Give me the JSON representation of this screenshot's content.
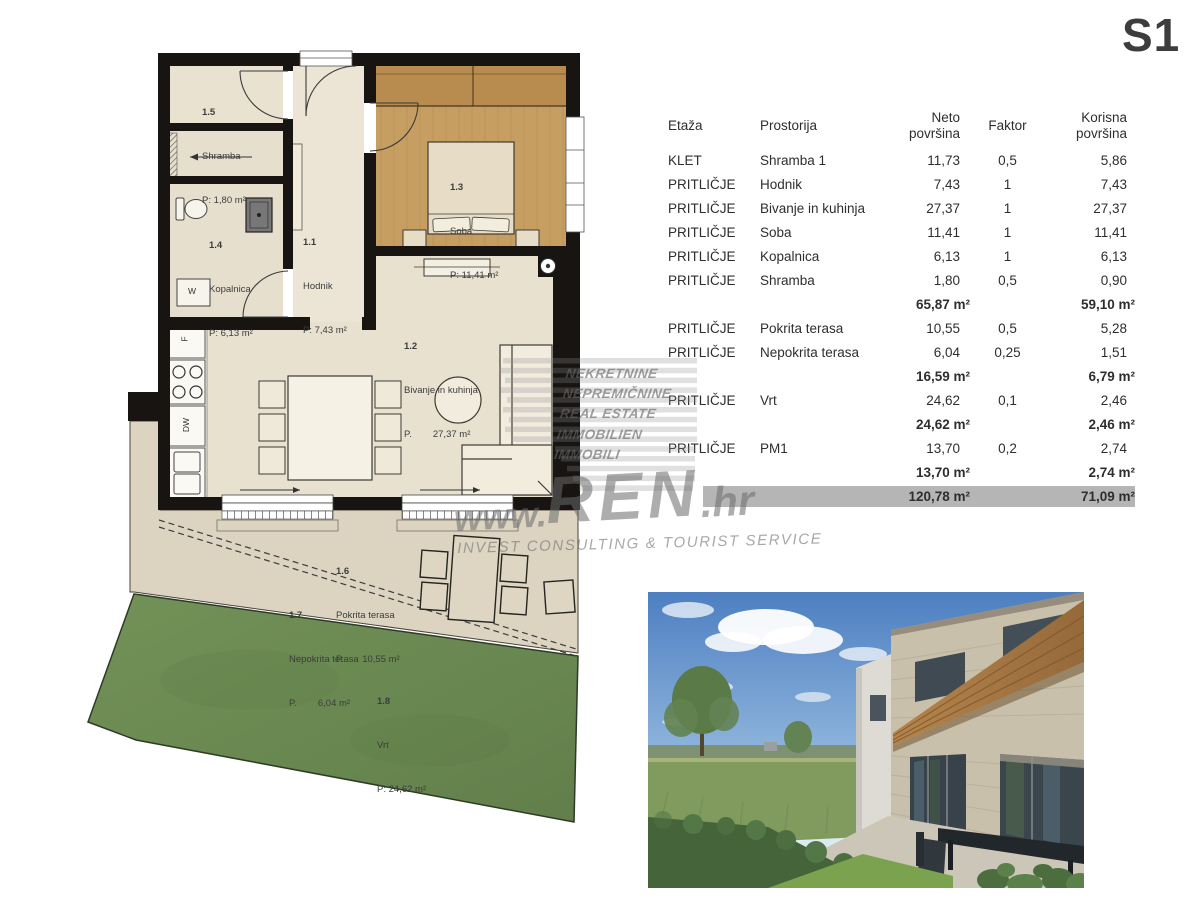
{
  "unit_label": "S1",
  "colors": {
    "wall": "#171412",
    "floor_beige": "#e9e1d0",
    "floor_wood": "#c79e62",
    "terrace": "#dcd4c1",
    "garden": "#6d8f54",
    "total_row_bg": "#b5b5b5",
    "watermark_gray": "#8a8a8a"
  },
  "watermark": {
    "brand_lines": [
      "NEKRETNINE",
      "NEPREMIČNINE",
      "REAL ESTATE",
      "IMMOBILIEN",
      "IMMOBILI"
    ],
    "url_www": "www.",
    "url_name": "REN",
    "url_tld": ".hr",
    "tagline": "INVEST CONSULTING & TOURIST SERVICE"
  },
  "floorplan": {
    "rooms": [
      {
        "num": "1.5",
        "name": "Shramba",
        "area": "P: 1,80 m²"
      },
      {
        "num": "1.4",
        "name": "Kopalnica",
        "area": "P: 6,13 m²"
      },
      {
        "num": "1.1",
        "name": "Hodnik",
        "area": "P: 7,43 m²"
      },
      {
        "num": "1.3",
        "name": "Soba",
        "area": "P: 11,41 m²"
      },
      {
        "num": "1.2",
        "name": "Bivanje in kuhinja",
        "area": "P.        27,37 m²"
      },
      {
        "num": "1.6",
        "name": "Pokrita terasa",
        "area": "P.       10,55 m²"
      },
      {
        "num": "1.7",
        "name": "Nepokrita terasa",
        "area": "P.        6,04 m²"
      },
      {
        "num": "1.8",
        "name": "Vrt",
        "area": "P: 24,62 m²"
      }
    ],
    "appliances": {
      "washer": "W",
      "fridge": "F",
      "dishwasher": "DW"
    }
  },
  "table": {
    "headers": [
      "Etaža",
      "Prostorija",
      "Neto površina",
      "Faktor",
      "Korisna površina"
    ],
    "rows": [
      {
        "type": "data",
        "etaza": "KLET",
        "prostorija": "Shramba 1",
        "neto": "11,73",
        "faktor": "0,5",
        "korisna": "5,86"
      },
      {
        "type": "data",
        "etaza": "PRITLIČJE",
        "prostorija": "Hodnik",
        "neto": "7,43",
        "faktor": "1",
        "korisna": "7,43"
      },
      {
        "type": "data",
        "etaza": "PRITLIČJE",
        "prostorija": "Bivanje in kuhinja",
        "neto": "27,37",
        "faktor": "1",
        "korisna": "27,37"
      },
      {
        "type": "data",
        "etaza": "PRITLIČJE",
        "prostorija": "Soba",
        "neto": "11,41",
        "faktor": "1",
        "korisna": "11,41"
      },
      {
        "type": "data",
        "etaza": "PRITLIČJE",
        "prostorija": "Kopalnica",
        "neto": "6,13",
        "faktor": "1",
        "korisna": "6,13"
      },
      {
        "type": "data",
        "etaza": "PRITLIČJE",
        "prostorija": "Shramba",
        "neto": "1,80",
        "faktor": "0,5",
        "korisna": "0,90"
      },
      {
        "type": "subtotal",
        "neto": "65,87 m²",
        "korisna": "59,10 m²"
      },
      {
        "type": "data",
        "etaza": "PRITLIČJE",
        "prostorija": "Pokrita terasa",
        "neto": "10,55",
        "faktor": "0,5",
        "korisna": "5,28"
      },
      {
        "type": "data",
        "etaza": "PRITLIČJE",
        "prostorija": "Nepokrita terasa",
        "neto": "6,04",
        "faktor": "0,25",
        "korisna": "1,51"
      },
      {
        "type": "subtotal",
        "neto": "16,59 m²",
        "korisna": "6,79 m²"
      },
      {
        "type": "data",
        "etaza": "PRITLIČJE",
        "prostorija": "Vrt",
        "neto": "24,62",
        "faktor": "0,1",
        "korisna": "2,46"
      },
      {
        "type": "subtotal",
        "neto": "24,62 m²",
        "korisna": "2,46 m²"
      },
      {
        "type": "data",
        "etaza": "PRITLIČJE",
        "prostorija": "PM1",
        "neto": "13,70",
        "faktor": "0,2",
        "korisna": "2,74"
      },
      {
        "type": "subtotal",
        "neto": "13,70 m²",
        "korisna": "2,74 m²"
      },
      {
        "type": "total",
        "neto": "120,78 m²",
        "korisna": "71,09 m²"
      }
    ]
  }
}
